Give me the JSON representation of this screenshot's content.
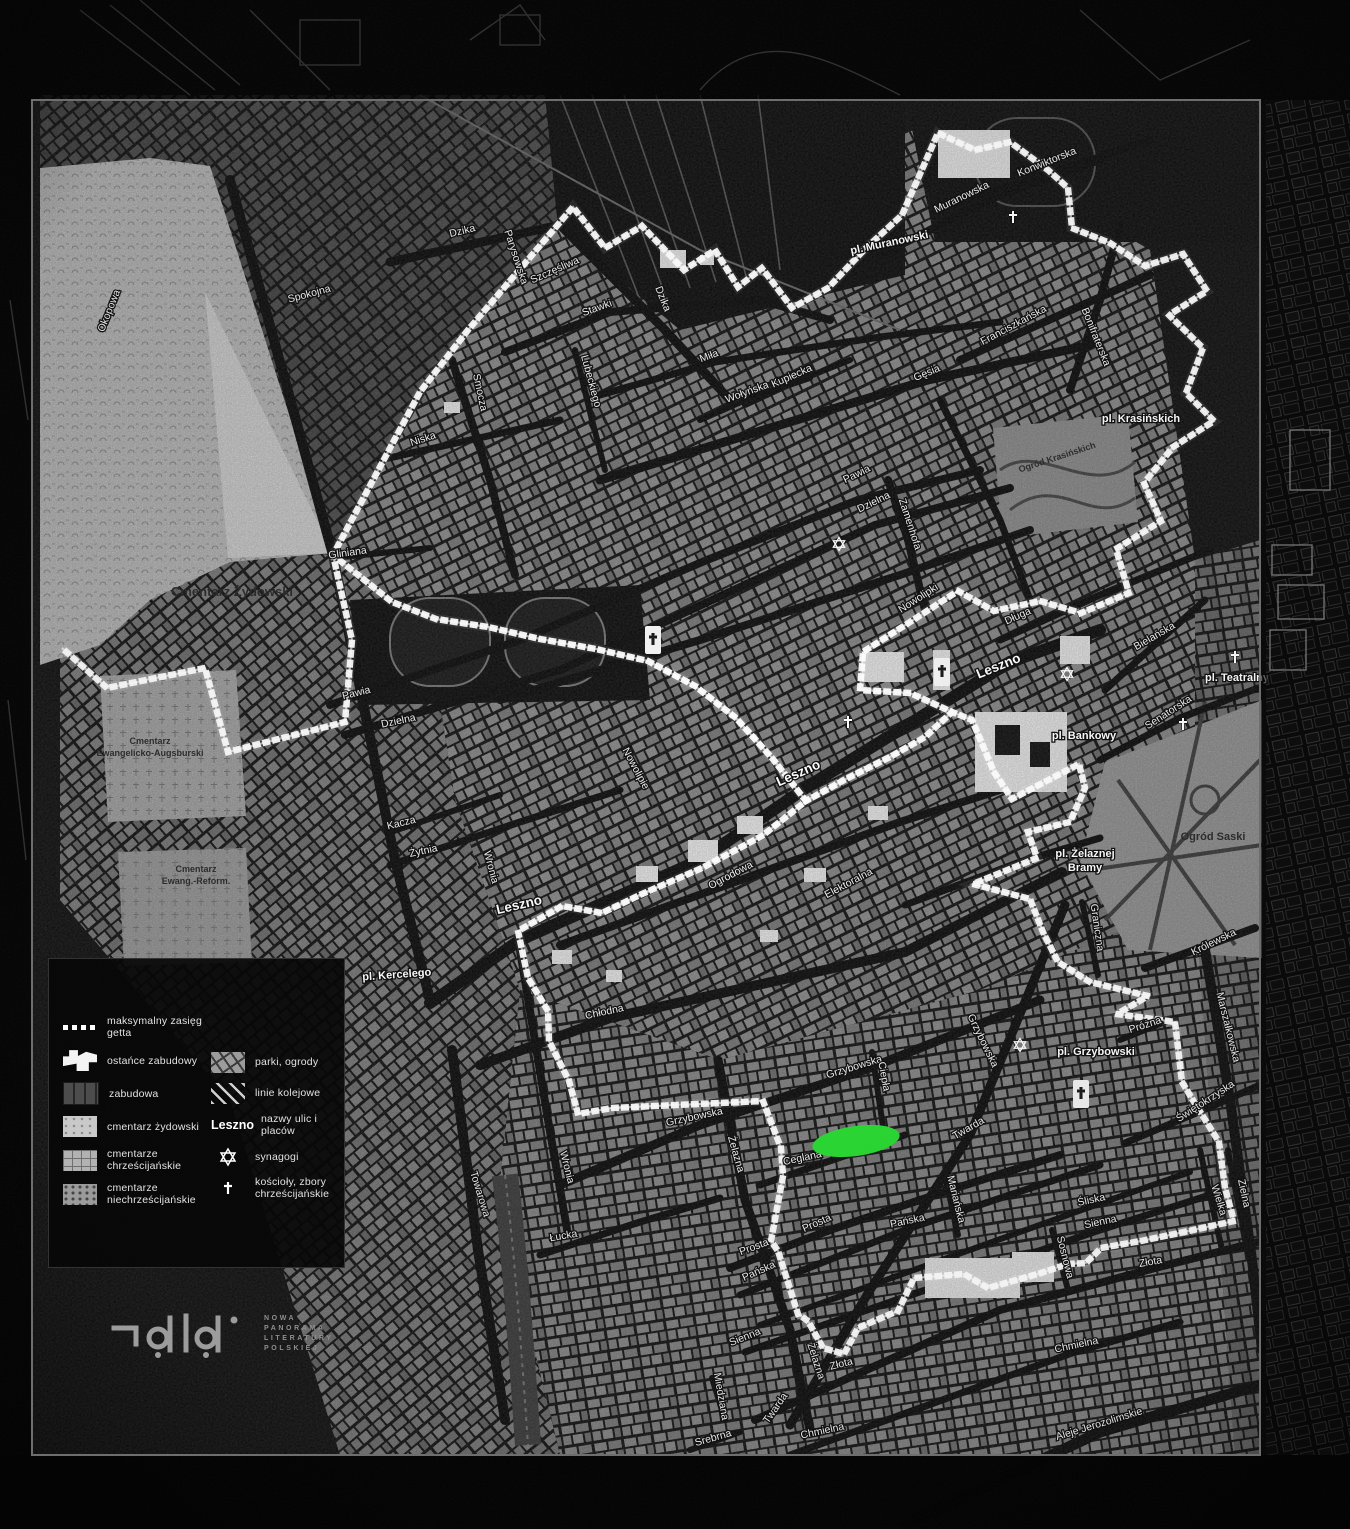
{
  "colors": {
    "marker_green": "#2bdb34",
    "boundary": "#ffffff",
    "map_bg": "#141414",
    "outside": "#060606",
    "panel": "#0b0b0b",
    "street_label": "#f3f3f3",
    "dark_label": "#2e2e2e"
  },
  "legend": {
    "column1": [
      {
        "swatch": "dash",
        "label": "maksymalny zasięg getta"
      },
      {
        "swatch": "ruin",
        "label": "ostańce zabudowy"
      },
      {
        "swatch": "block",
        "label": "zabudowa"
      },
      {
        "swatch": "cem-jew",
        "label": "cmentarz żydowski"
      },
      {
        "swatch": "cem-chr",
        "label": "cmentarze chrześcijańskie"
      },
      {
        "swatch": "cem-non",
        "label": "cmentarze niechrześcijańskie"
      }
    ],
    "column2": [
      {
        "swatch": "park",
        "label": "parki, ogrody"
      },
      {
        "swatch": "rail",
        "label": "linie kolejowe"
      },
      {
        "swatch": "text",
        "sample": "Leszno",
        "label": "nazwy ulic i placów"
      },
      {
        "swatch": "star",
        "label": "synagogi"
      },
      {
        "swatch": "cross",
        "label": "kościoły, zbory chrześcijańskie"
      }
    ]
  },
  "logo": {
    "lines": [
      "NOWA",
      "PANORAMA",
      "LITERATURY",
      "POLSKIEJ"
    ]
  },
  "marker": {
    "x": 856,
    "y": 1141,
    "rx": 44,
    "ry": 15,
    "rot": -8
  },
  "boundary": {
    "main": "M333,555 L420,392 L468,330 L573,207 L605,248 L642,226 L684,270 L715,250 L738,287 L762,268 L792,308 L828,288 L864,250 L902,215 L938,133 L975,150 L1010,142 L1048,170 L1068,188 L1072,228 L1110,243 L1145,266 L1183,254 L1207,291 L1169,315 L1203,348 L1186,393 L1214,421 L1173,447 L1144,483 L1161,521 L1116,549 L1129,593 L1081,613 L1040,601 L994,611 L958,591 L910,622 L863,652 L860,690 L910,693 L952,712 L972,720 L994,772 L1012,799 L1079,764 L1085,788 L1070,822 L1028,832 L1037,858 L973,884 L1030,899 L1043,932 L1058,962 L1090,982 L1148,996 L1117,1014 L1175,1022 L1182,1082 L1194,1102 L1219,1142 L1225,1188 L1234,1221 L1184,1232 L1141,1241 L1101,1248 L1086,1263 L1068,1264 L1041,1273 L988,1288 L964,1274 L914,1278 L898,1311 L874,1321 L858,1328 L844,1354 L823,1348 L808,1321 L798,1314 L778,1251 L771,1241 L783,1176 L781,1148 L763,1101 L612,1108 L578,1114 L569,1081 L549,1041 L548,1011 L528,978 L518,931 L562,906 L602,913 L642,894 L702,868 L762,836 L806,801 L772,758 L736,718 L695,686 L648,661 L596,649 L540,639 L488,627 L436,619 L392,602 Z",
    "cemetery_arm": "M333,555 L352,640 L345,722 L228,752 L205,668 L107,688 L62,648",
    "extra": "M806,801 L846,779 L890,757 L925,737 L952,712"
  },
  "labels": {
    "streets": [
      [
        "Okopowa",
        112,
        312,
        -68
      ],
      [
        "Spokojna",
        310,
        297,
        -15
      ],
      [
        "Dzika",
        463,
        234,
        -14
      ],
      [
        "Parysowska",
        513,
        258,
        72
      ],
      [
        "Szczęśliwa",
        556,
        273,
        -24
      ],
      [
        "Stawki",
        598,
        311,
        -20
      ],
      [
        "Dzika",
        660,
        300,
        68
      ],
      [
        "Smocza",
        477,
        393,
        78
      ],
      [
        "Niska",
        424,
        442,
        -18
      ],
      [
        "Lubeckiego",
        588,
        382,
        75
      ],
      [
        "Miła",
        710,
        359,
        -20
      ],
      [
        "Wołyńska",
        748,
        395,
        -20
      ],
      [
        "Kupiecka",
        793,
        379,
        -24
      ],
      [
        "Muranowska",
        963,
        200,
        -26
      ],
      [
        "Konwiktorska",
        1048,
        165,
        -22
      ],
      [
        "Bonifraterska",
        1093,
        338,
        68
      ],
      [
        "Franciszkańska",
        1015,
        328,
        -28
      ],
      [
        "Gęsia",
        928,
        376,
        -22
      ],
      [
        "Zamenhofa",
        907,
        525,
        72
      ],
      [
        "Pawia",
        858,
        477,
        -26
      ],
      [
        "Dzielna",
        875,
        505,
        -26
      ],
      [
        "Pawia",
        357,
        696,
        -14
      ],
      [
        "Dzielna",
        399,
        724,
        -12
      ],
      [
        "Gliniana",
        348,
        556,
        -8
      ],
      [
        "Kacza",
        402,
        826,
        -14
      ],
      [
        "Żytnia",
        424,
        854,
        -12
      ],
      [
        "Wronia",
        488,
        868,
        75
      ],
      [
        "Nowolipie",
        633,
        770,
        62
      ],
      [
        "Nowolipki",
        920,
        601,
        -33
      ],
      [
        "Długa",
        1019,
        619,
        -24
      ],
      [
        "Bielańska",
        1156,
        639,
        -30
      ],
      [
        "Senatorska",
        1170,
        715,
        -33
      ],
      [
        "Ogrodowa",
        732,
        878,
        -28
      ],
      [
        "Chłodna",
        605,
        1015,
        -12
      ],
      [
        "Elektoralna",
        850,
        886,
        -28
      ],
      [
        "Graniczna",
        1094,
        928,
        82
      ],
      [
        "Królewska",
        1215,
        945,
        -26
      ],
      [
        "Marszałkowska",
        1225,
        1028,
        76
      ],
      [
        "Próżna",
        1146,
        1028,
        -18
      ],
      [
        "Świętokrzyska",
        1207,
        1104,
        -33
      ],
      [
        "Zielna",
        1241,
        1194,
        78
      ],
      [
        "Wielka",
        1216,
        1201,
        73
      ],
      [
        "Grzybowska",
        855,
        1070,
        -17
      ],
      [
        "Grzybowska",
        695,
        1120,
        -12
      ],
      [
        "Grzybowska",
        980,
        1042,
        64
      ],
      [
        "Ciepła",
        881,
        1077,
        80
      ],
      [
        "Twarda",
        970,
        1131,
        -30
      ],
      [
        "Twarda",
        778,
        1410,
        -55
      ],
      [
        "Ceglana",
        803,
        1161,
        -12
      ],
      [
        "Mariańska",
        953,
        1200,
        76
      ],
      [
        "Prosta",
        818,
        1226,
        -24
      ],
      [
        "Prosta",
        755,
        1250,
        -20
      ],
      [
        "Pańska",
        908,
        1224,
        -12
      ],
      [
        "Pańska",
        760,
        1274,
        -24
      ],
      [
        "Śliska",
        1092,
        1203,
        -12
      ],
      [
        "Sienna",
        1101,
        1225,
        -12
      ],
      [
        "Sienna",
        746,
        1340,
        -22
      ],
      [
        "Złota",
        1151,
        1265,
        -10
      ],
      [
        "Złota",
        842,
        1367,
        -14
      ],
      [
        "Chmielna",
        1077,
        1348,
        -12
      ],
      [
        "Chmielna",
        823,
        1434,
        -12
      ],
      [
        "Żelazna",
        733,
        1155,
        74
      ],
      [
        "Żelazna",
        813,
        1362,
        72
      ],
      [
        "Sosnowa",
        1062,
        1258,
        76
      ],
      [
        "Towarowa",
        477,
        1195,
        73
      ],
      [
        "Łucka",
        564,
        1239,
        -10
      ],
      [
        "Miedziana",
        718,
        1397,
        80
      ],
      [
        "Srebrna",
        714,
        1441,
        -16
      ],
      [
        "Aleje Jerozolimskie",
        1100,
        1427,
        -17
      ],
      [
        "Wronia",
        564,
        1168,
        76
      ]
    ],
    "streets_big": [
      [
        "Leszno",
        520,
        909,
        -13
      ],
      [
        "Leszno",
        800,
        777,
        -24
      ],
      [
        "Leszno",
        1000,
        670,
        -22
      ]
    ],
    "places": [
      [
        "pl. Muranowski",
        890,
        246,
        -12
      ],
      [
        "pl. Krasińskich",
        1141,
        422,
        0
      ],
      [
        "pl. Teatralny",
        1237,
        681,
        0
      ],
      [
        "pl. Bankowy",
        1084,
        739,
        0
      ],
      [
        "pl. Żelaznej",
        1085,
        857,
        0
      ],
      [
        "Bramy",
        1085,
        871,
        0
      ],
      [
        "pl. Grzybowski",
        1096,
        1055,
        0
      ],
      [
        "pl. Kercelego",
        397,
        978,
        -4
      ]
    ],
    "dark": [
      [
        "Cmentarz Żydowski",
        232,
        596,
        0,
        13
      ],
      [
        "Cmentarz",
        150,
        744,
        0,
        9
      ],
      [
        "Ewangelicko-Augsburski",
        150,
        756,
        0,
        9
      ],
      [
        "Cmentarz",
        196,
        872,
        0,
        9
      ],
      [
        "Ewang.-Reform.",
        196,
        884,
        0,
        9
      ],
      [
        "Ogród Saski",
        1213,
        840,
        0,
        11
      ],
      [
        "Ogród Krasińskich",
        1058,
        460,
        -18,
        9
      ]
    ]
  },
  "symbols": {
    "synagogues": [
      [
        839,
        544
      ],
      [
        1067,
        674
      ],
      [
        1020,
        1045
      ]
    ],
    "crosses": [
      [
        848,
        723
      ],
      [
        1235,
        658
      ],
      [
        1183,
        725
      ],
      [
        1013,
        218
      ]
    ],
    "churches": [
      [
        653,
        640
      ],
      [
        942,
        672
      ],
      [
        1081,
        1094
      ]
    ]
  }
}
